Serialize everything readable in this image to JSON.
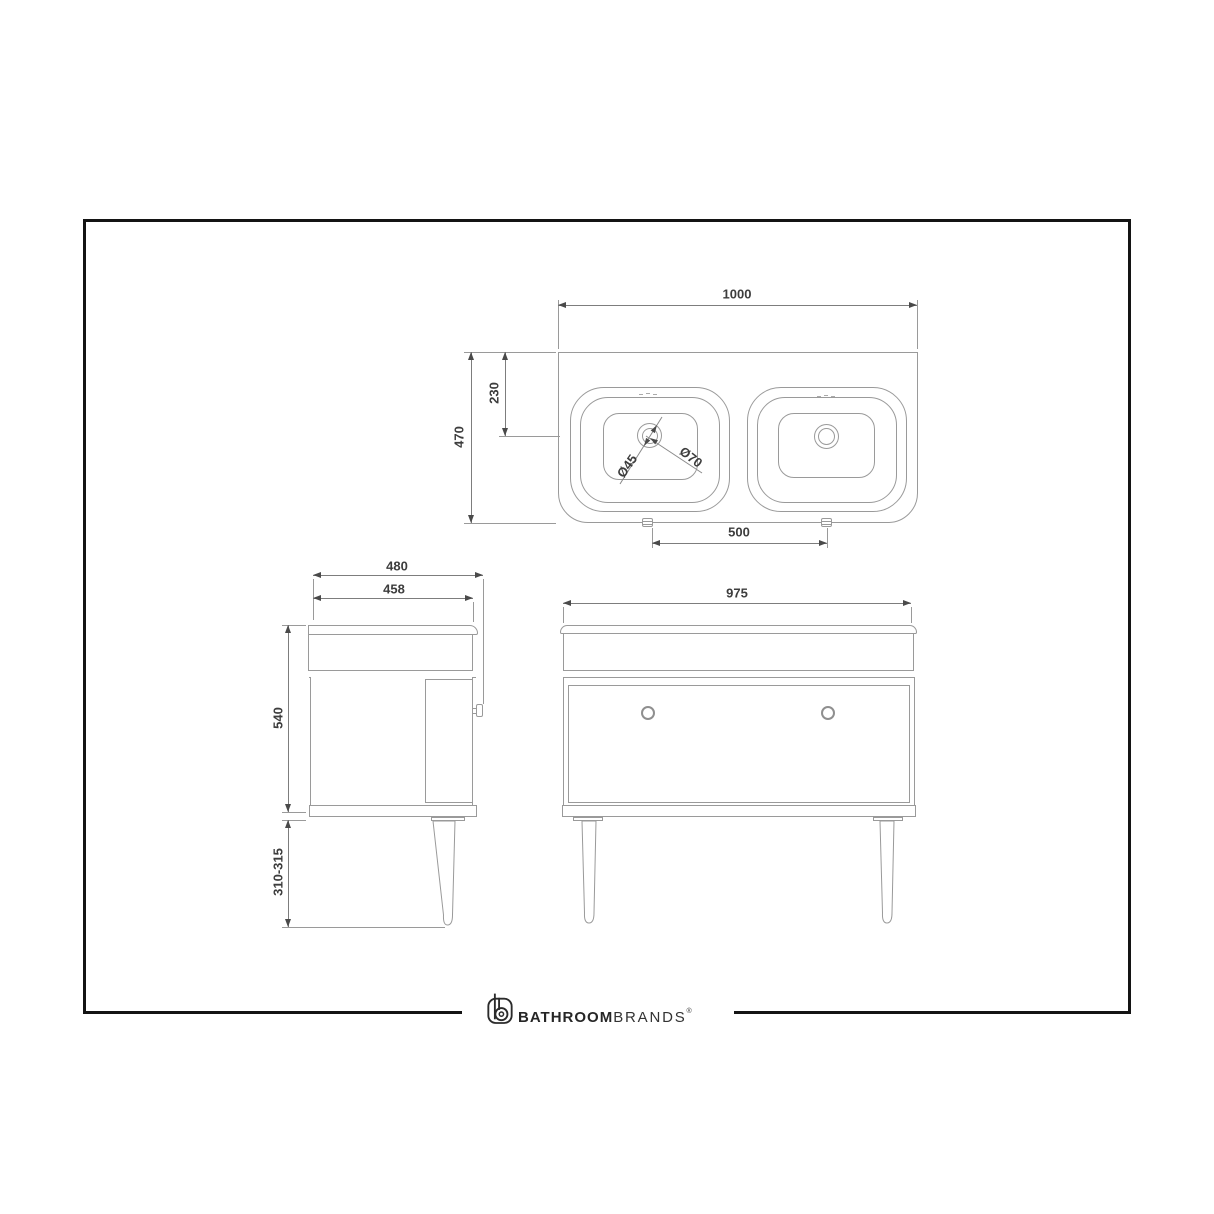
{
  "brand": {
    "name_bold": "BATHROOM",
    "name_light": "BRANDS",
    "registered_mark": "®",
    "icon": "b-logo-icon"
  },
  "colors": {
    "frame": "#141414",
    "drawing_line": "#9a9a9a",
    "dimension_line": "#7d7d7d",
    "dimension_text": "#3d3d3d",
    "logo": "#262626"
  },
  "plan_view": {
    "overall_width": "1000",
    "overall_depth": "470",
    "tap_centre_setback": "230",
    "basin_centres": "500",
    "tap_hole_dia": "Ø45",
    "tap_hole_outer_dia": "Ø70"
  },
  "side_view": {
    "overall_depth": "480",
    "cabinet_depth": "458",
    "cabinet_height": "540",
    "leg_height": "310-315"
  },
  "front_view": {
    "cabinet_width": "975"
  }
}
